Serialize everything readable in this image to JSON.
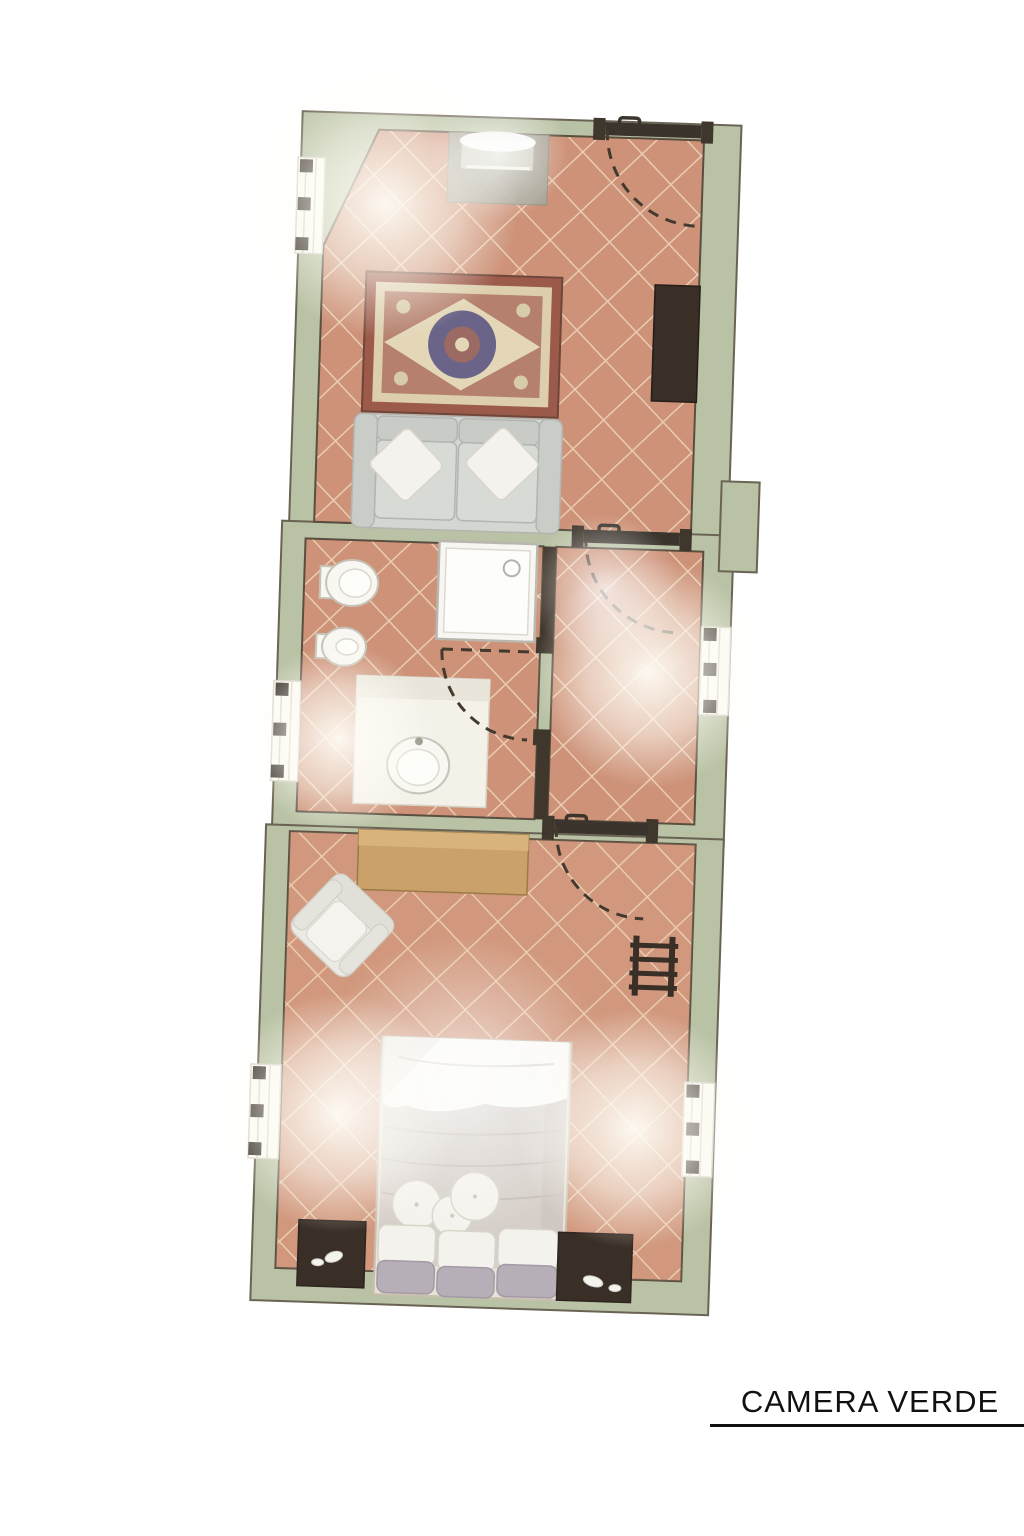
{
  "title": {
    "label": "CAMERA VERDE"
  },
  "palette": {
    "background": "#ffffff",
    "wall_green": "#b9c2a4",
    "wall_outline": "#6a6354",
    "floor_terracotta": "#cd9278",
    "tile_grout": "#e9ccb2",
    "interior_wall_dark": "#3f362c",
    "door_dark": "#3a342c",
    "fixture_white": "#f8f7f2",
    "sofa_gray": "#d4d6d2",
    "rug_red": "#9c5a4a",
    "rug_cream": "#ddcfae",
    "rug_navy": "#6a6488",
    "wood_desk": "#c9a169",
    "dark_furniture": "#3a2f27",
    "bed_duvet_white": "#faf9f6",
    "bed_duvet_gray": "#d6cfc9",
    "title_text": "#111111"
  }
}
